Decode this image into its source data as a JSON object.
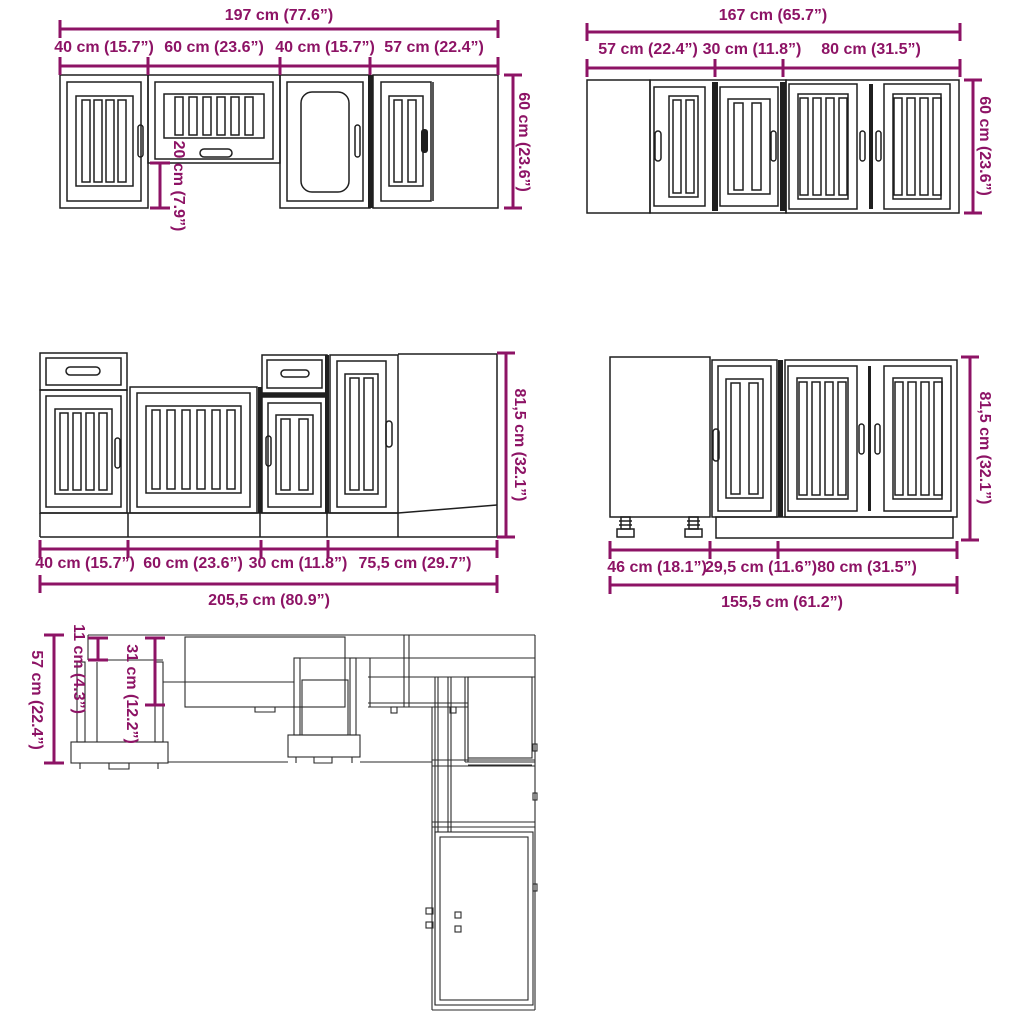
{
  "colors": {
    "dimension": "#8D1365",
    "line": "#1f1f1f",
    "background": "#ffffff"
  },
  "wall_run_a": {
    "total": "197 cm (77.6”)",
    "segments": [
      "40 cm (15.7”)",
      "60 cm (23.6”)",
      "40 cm (15.7”)",
      "57 cm (22.4”)"
    ],
    "height": "60 cm (23.6”)",
    "sub_height": "20 cm (7.9”)"
  },
  "wall_run_b": {
    "total": "167 cm (65.7”)",
    "segments": [
      "57 cm (22.4”)",
      "30 cm (11.8”)",
      "80 cm (31.5”)"
    ],
    "height": "60 cm (23.6”)"
  },
  "base_run_a": {
    "total": "205,5 cm (80.9”)",
    "segments": [
      "40 cm (15.7”)",
      "60 cm (23.6”)",
      "30 cm (11.8”)",
      "75,5 cm (29.7”)"
    ],
    "height": "81,5 cm (32.1”)"
  },
  "base_run_b": {
    "total": "155,5 cm (61.2”)",
    "segments": [
      "46 cm (18.1”)",
      "29,5 cm (11.6”)",
      "80 cm (31.5”)"
    ],
    "height": "81,5 cm (32.1”)"
  },
  "plan_view": {
    "total_depth": "57 cm (22.4”)",
    "small_depth": "11 cm (4.3”)",
    "mid_depth": "31 cm (12.2”)"
  }
}
